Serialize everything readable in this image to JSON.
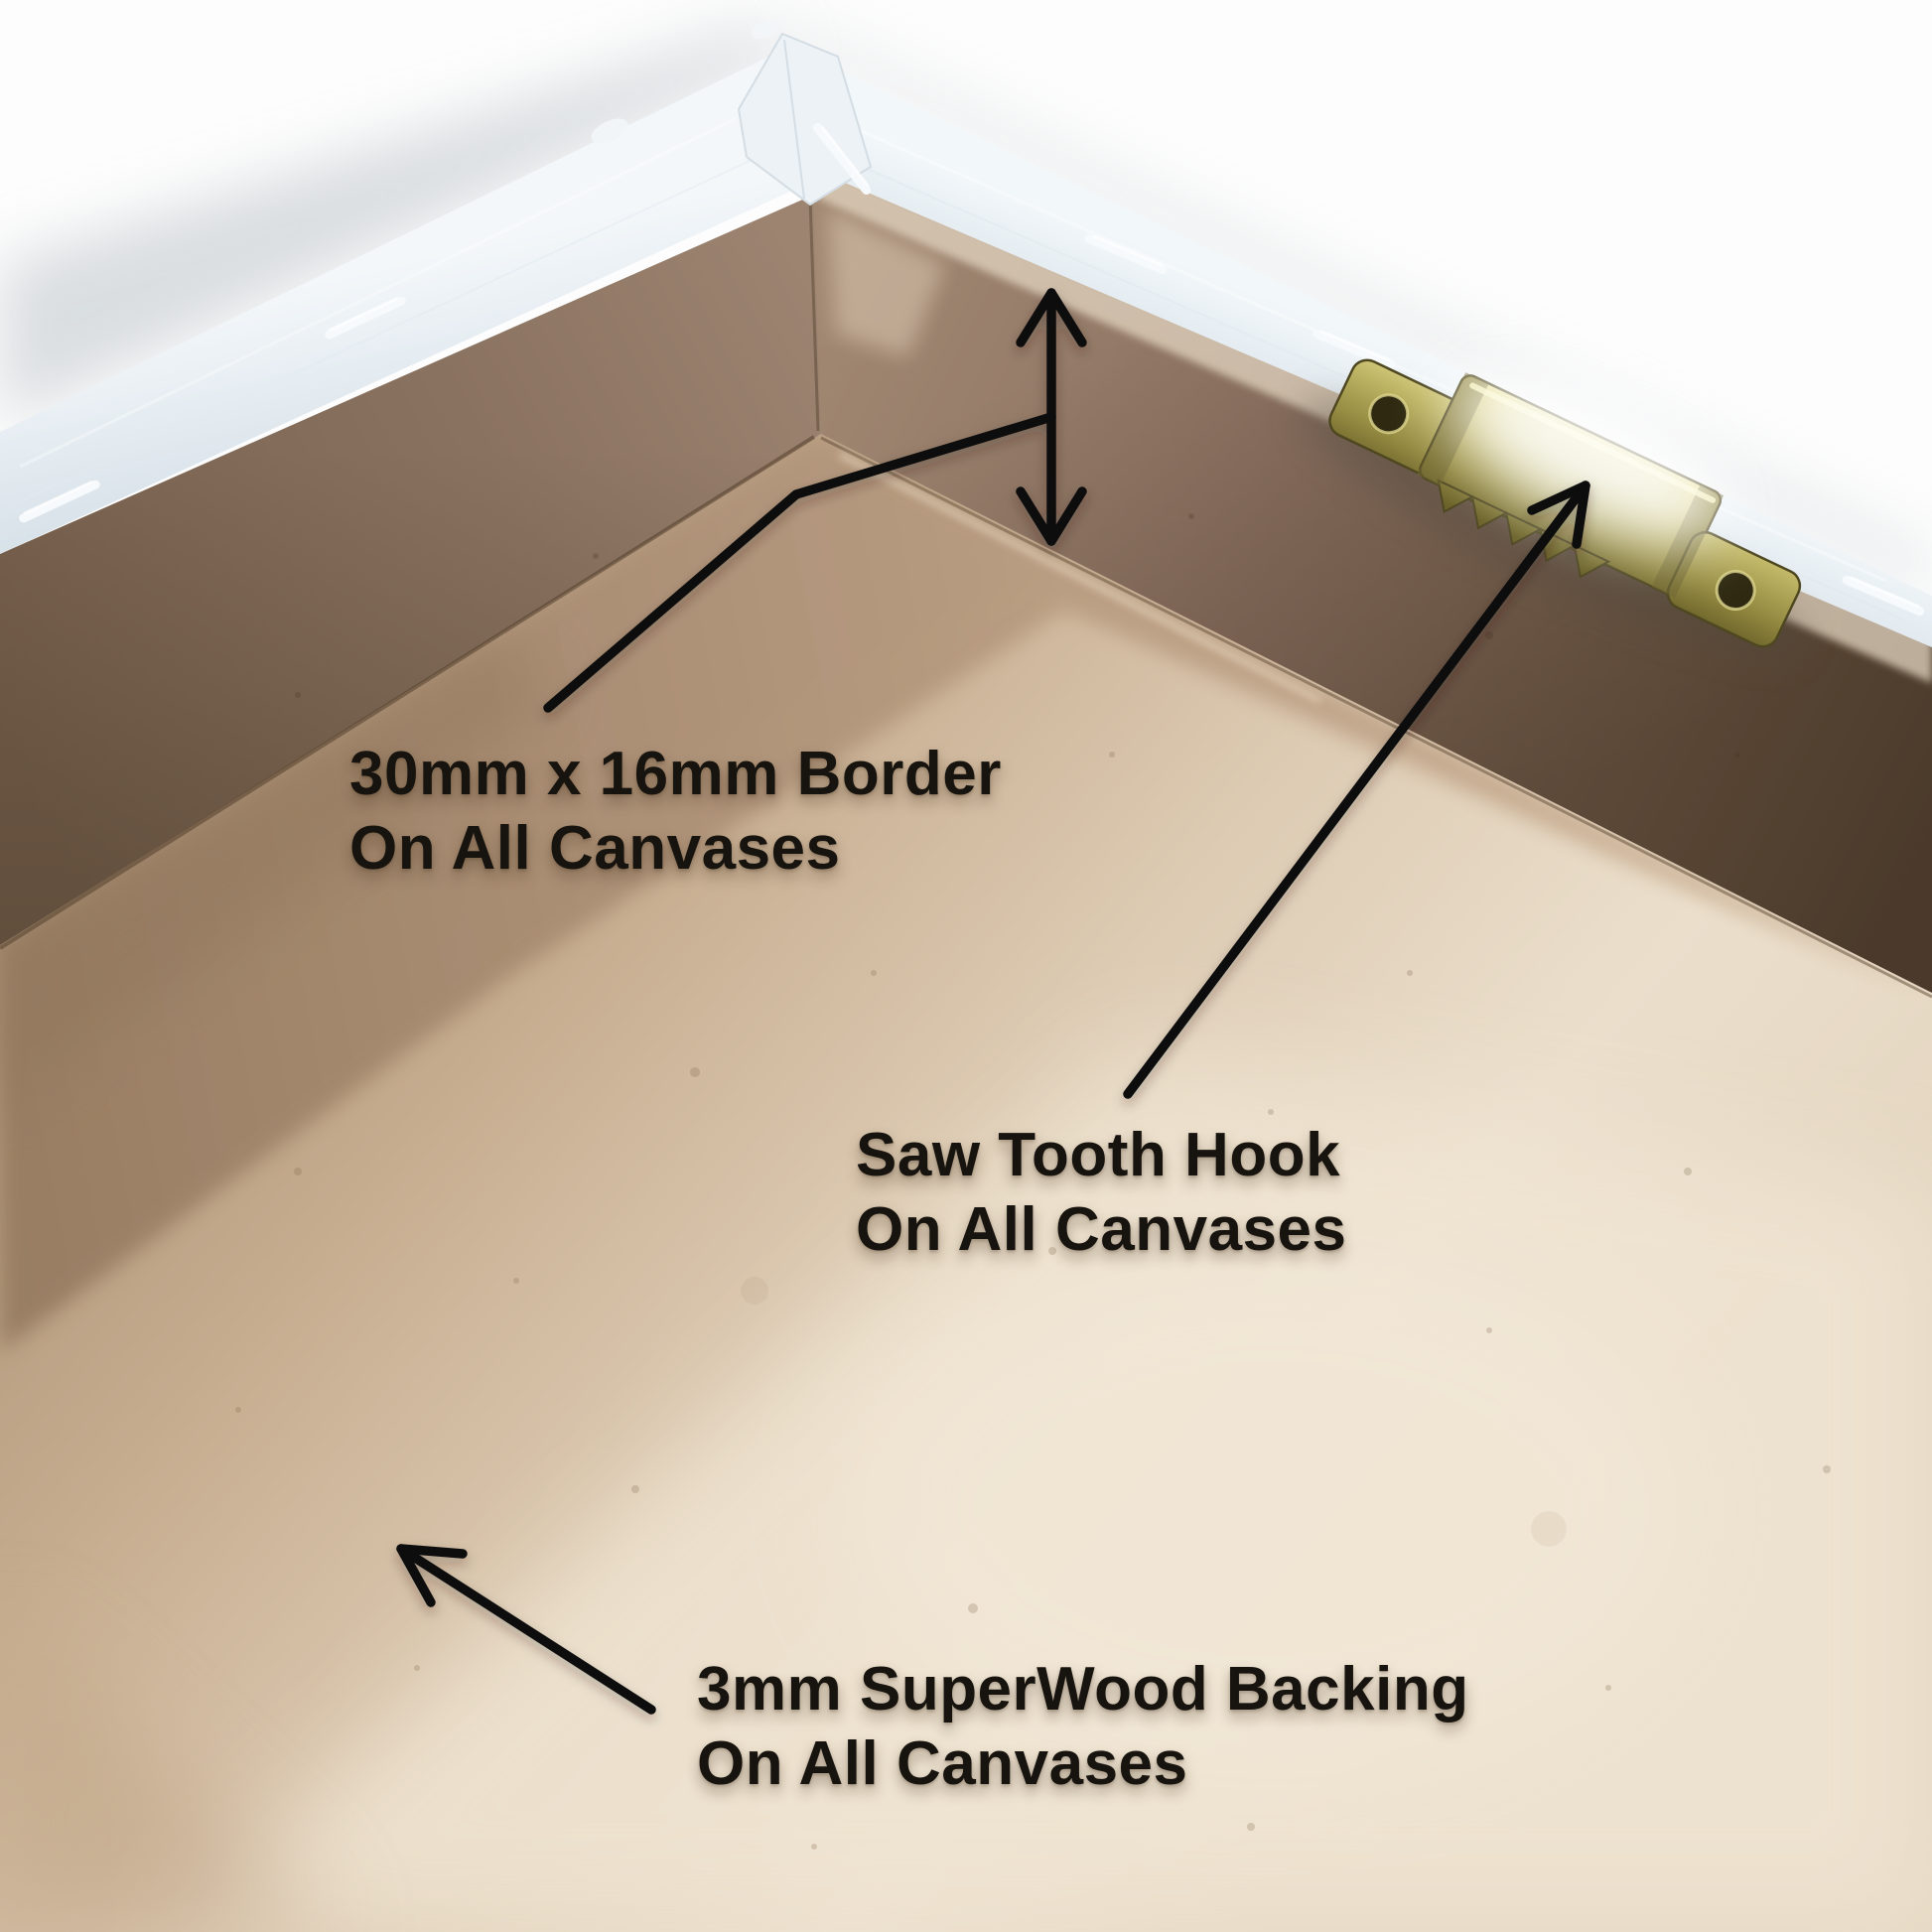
{
  "scene": {
    "description": "Rear corner view of a stretched canvas: white canvas-wrapped stretcher bars with staples, brown MDF border walls, wood backing board and a brass saw tooth hanging hook, annotated with black arrows"
  },
  "annotations": {
    "border_label": {
      "line1": "30mm x 16mm Border",
      "line2": "On All Canvases"
    },
    "hook_label": {
      "line1": "Saw Tooth Hook",
      "line2": "On All Canvases"
    },
    "backing_label": {
      "line1": "3mm SuperWood Backing",
      "line2": "On All Canvases"
    }
  },
  "colors": {
    "background": "#fdfdfd",
    "drop_shadow": "#c7ccd1",
    "canvas_edge_white": "#eaf1f6",
    "mdf_border_brown": "#87705d",
    "mdf_border_dark": "#5c4937",
    "backing_light": "#ebdfcc",
    "backing_mid": "#d9c4aa",
    "backing_shadow": "#a3896f",
    "hook_brass": "#b3a957",
    "annotation": "#111111",
    "label_text": "#17140f"
  }
}
